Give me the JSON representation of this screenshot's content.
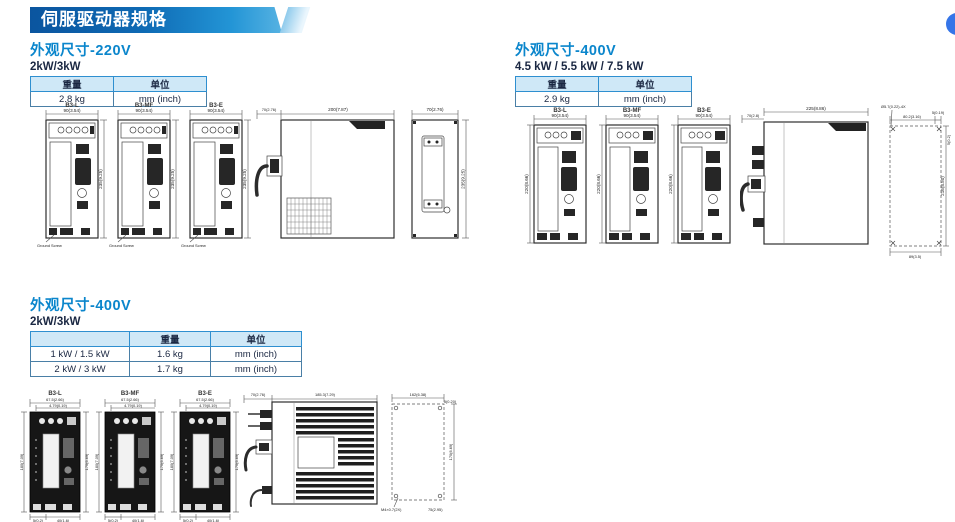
{
  "page": {
    "banner_title": "伺服驱动器规格"
  },
  "colors": {
    "accent_blue": "#0b86cc",
    "banner_dark": "#0b559f",
    "banner_light": "#56b2e2",
    "table_header_bg": "#cfe8f7",
    "bubble_blue": "#3575e8"
  },
  "sections": {
    "s1": {
      "title": "外观尺寸-220V",
      "subtitle": "2kW/3kW",
      "table": {
        "headers": [
          "重量",
          "单位"
        ],
        "rows": [
          [
            "2.8 kg",
            "mm (inch)"
          ]
        ]
      },
      "drives": [
        "B3-L",
        "B3-MF",
        "B3-E"
      ],
      "dims": {
        "front_w": "90(3.54)",
        "front_h": "235(9.25)",
        "side_conn": "70(2.76)",
        "side_d": "200(7.87)",
        "rear_w": "70(2.76)",
        "rear_h": "235(9.25)",
        "ground": "Ground Screw"
      }
    },
    "s2": {
      "title": "外观尺寸-400V",
      "subtitle": "4.5 kW / 5.5 kW / 7.5 kW",
      "table": {
        "headers": [
          "重量",
          "单位"
        ],
        "rows": [
          [
            "2.9 kg",
            "mm (inch)"
          ]
        ]
      },
      "drives": [
        "B3-L",
        "B3-MF",
        "B3-E"
      ],
      "dims": {
        "front_w": "90(3.54)",
        "front_h": "220(8.66)",
        "side_conn": "70(2.8)",
        "side_d": "225(8.86)",
        "hole": "Ø5.7(0.22)-4X",
        "mt_w": "80.2(3.16)",
        "mt_off": "5(0.19)",
        "mt_corner": "5(0.2)",
        "mt_h": "216(8.50)",
        "mt_bw": "89(3.5)"
      }
    },
    "s3": {
      "title": "外观尺寸-400V",
      "subtitle": "2kW/3kW",
      "table": {
        "headers": [
          "",
          "重量",
          "单位"
        ],
        "rows": [
          [
            "1 kW / 1.5 kW",
            "1.6 kg",
            "mm (inch)"
          ],
          [
            "2 kW / 3 kW",
            "1.7 kg",
            "mm (inch)"
          ]
        ]
      },
      "drives": [
        "B3-L",
        "B3-MF",
        "B3-E"
      ],
      "dims": {
        "front_w": "67.5(2.66)",
        "front_w2": "4.79(0.19)",
        "front_hl": "180(7.09)",
        "front_hr": "170(6.69)",
        "front_b1": "5(0.2)",
        "front_b2": "40(1.6)",
        "side_conn": "70(2.76)",
        "side_d": "185.3(7.29)",
        "mt_w": "162(6.38)",
        "mt_off": "5(0.20)",
        "mt_h": "170(6.69)",
        "mt_label": "M4×0.7(2X)",
        "mt_bw": "75(2.95)"
      }
    }
  }
}
